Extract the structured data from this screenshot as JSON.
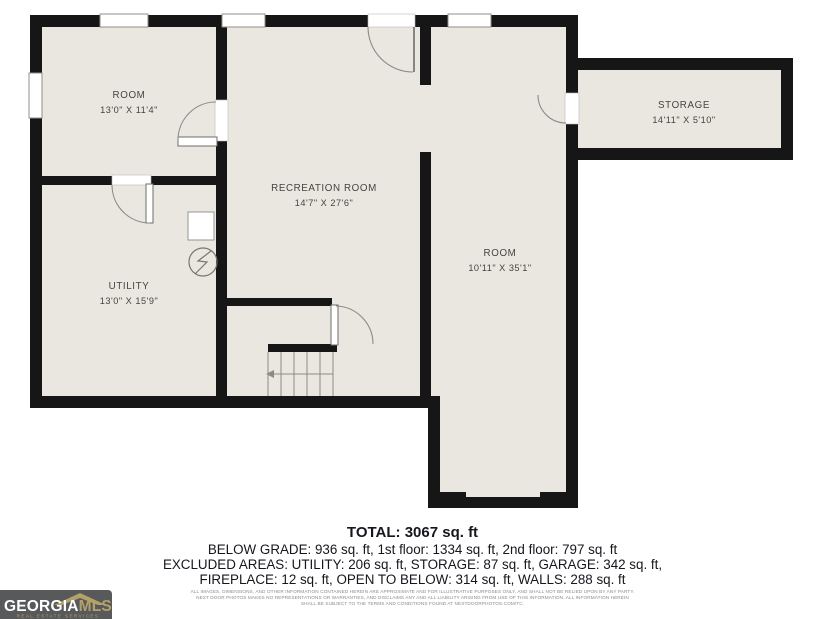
{
  "floorplan": {
    "rooms": [
      {
        "name": "ROOM",
        "dims": "13'0\" X 11'4\""
      },
      {
        "name": "RECREATION ROOM",
        "dims": "14'7\" X 27'6\""
      },
      {
        "name": "UTILITY",
        "dims": "13'0\" X 15'9\""
      },
      {
        "name": "ROOM",
        "dims": "10'11\" X 35'1\""
      },
      {
        "name": "STORAGE",
        "dims": "14'11\" X 5'10\""
      }
    ],
    "symbols": [
      "electrical-meter",
      "appliance-square",
      "stairs-down-arrow"
    ]
  },
  "summary": {
    "total": "TOTAL: 3067 sq. ft",
    "line1": "BELOW GRADE: 936 sq. ft, 1st floor: 1334 sq. ft, 2nd floor: 797 sq. ft",
    "line2": "EXCLUDED AREAS: UTILITY: 206 sq. ft, STORAGE: 87 sq. ft, GARAGE: 342 sq. ft,",
    "line3": "FIREPLACE: 12 sq. ft, OPEN TO BELOW: 314 sq. ft, WALLS: 288 sq. ft"
  },
  "disclaimer": {
    "line1": "ALL IMAGES, DIMENSIONS, AND OTHER INFORMATION CONTAINED HEREIN ARE APPROXIMATE AND FOR ILLUSTRATIVE PURPOSES ONLY, AND SHALL NOT BE RELIED UPON BY ANY PARTY.",
    "line2": "NEXT DOOR PHOTOS MAKES NO REPRESENTATIONS OR WARRANTIES, AND DISCLAIMS ANY AND ALL LIABILITY ARISING FROM USE OF THIS INFORMATION. ALL INFORMATION HEREIN",
    "line3": "SHALL BE SUBJECT TO THE TERMS AND CONDITIONS FOUND AT NEXTDOORPHOTOS.COM/TC."
  },
  "logo": {
    "brand_primary": "GEORGIA",
    "brand_secondary": "MLS",
    "tagline": "REAL ESTATE SERVICES"
  },
  "colors": {
    "wall": "#161616",
    "floor": "#e9e7e0",
    "logo_background": "#58595b",
    "logo_gold": "#b3a169"
  }
}
